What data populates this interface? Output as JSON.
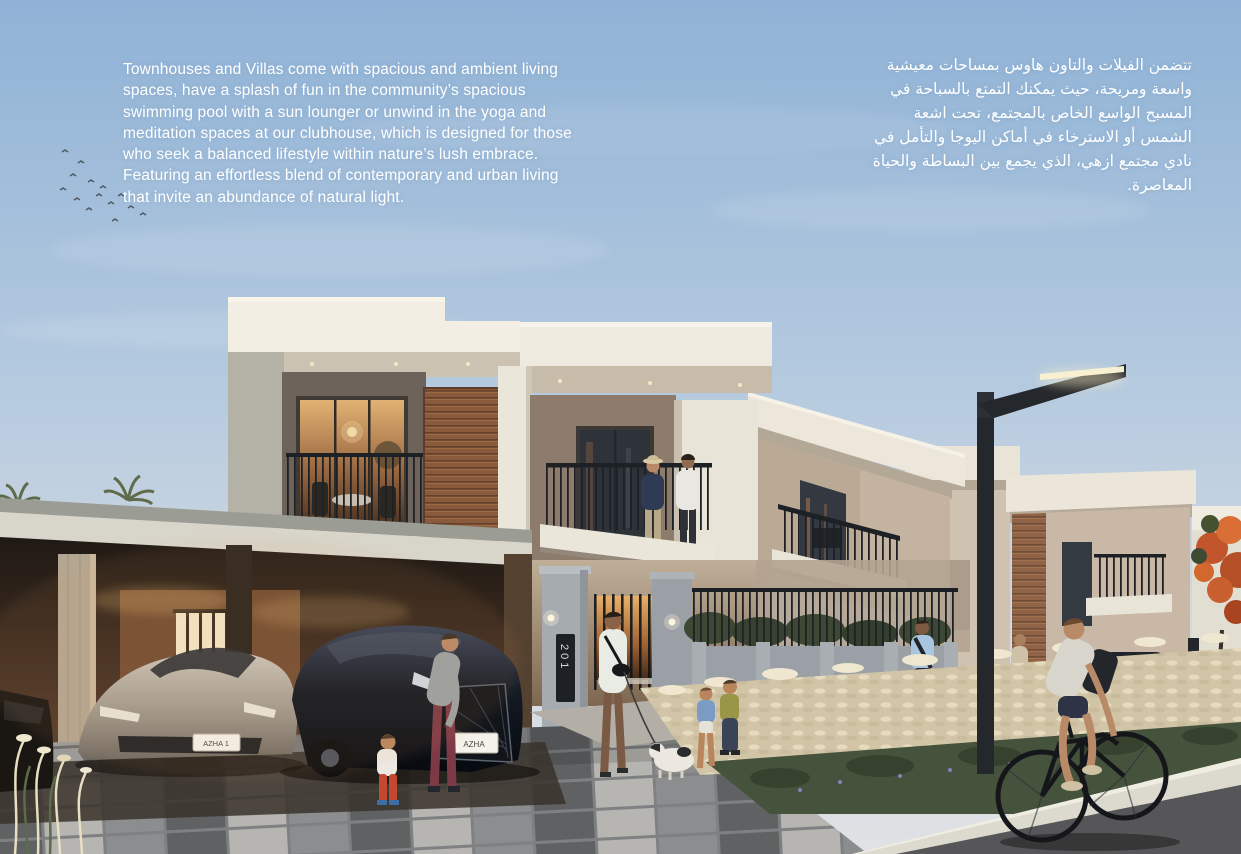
{
  "page": {
    "intro_en": "Townhouses and Villas come with spacious and ambient living\nspaces, have a splash of fun in the community’s spacious\nswimming pool with a sun lounger or unwind in the yoga and\nmeditation spaces at our clubhouse, which is designed for those\nwho seek a balanced lifestyle within nature’s lush embrace.\nFeaturing an effortless blend of contemporary and urban living\nthat invite an abundance of natural light.",
    "intro_ar": "تتضمن الفيلات والتاون هاوس بمساحات معيشية\nواسعة ومريحة، حيث يمكنك التمتع بالسباحة في\nالمسبح الواسع الخاص بالمجتمع، تحت اشعة\nالشمس أو الاسترخاء في أماكن اليوجا والتأمل في\nنادي مجتمع ازهي، الذي يجمع بين البساطة والحياة\nالمعاصرة."
  },
  "scene": {
    "house_number": "201",
    "car_plate_primary": "AZHA 1",
    "car_plate_secondary": "AZHA",
    "colors": {
      "sky_top": "#8fb2d6",
      "sky_horizon": "#dfe2e4",
      "fascia_white": "#f1ede2",
      "wall_beige": "#c3b3a0",
      "wall_taupe": "#8d7b6c",
      "wood_accent": "#8a5a3c",
      "stone_pillar": "#a3a8ad",
      "railing_black": "#202428",
      "window_glow": "#d99a55",
      "carport_shadow": "#2a211a",
      "paving_light": "#b6b5b1",
      "paving_dark": "#5f6163",
      "curb_white": "#dddad0",
      "road_asphalt": "#565558",
      "grass_plume": "#d2c5a7",
      "foliage_green": "#46533c",
      "text_color": "#ffffff"
    }
  }
}
